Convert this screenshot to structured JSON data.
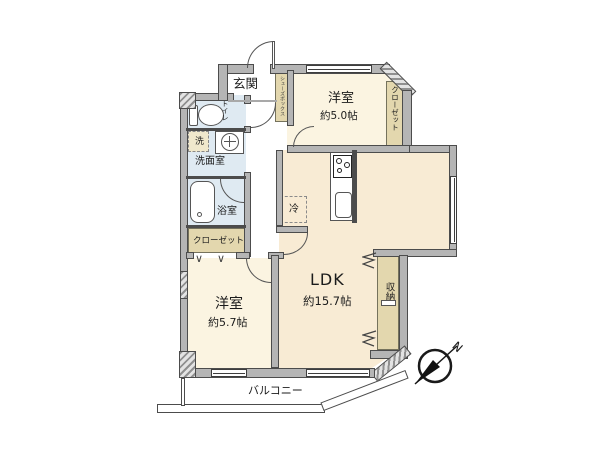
{
  "plan": {
    "rooms": {
      "entrance": {
        "label": "玄関"
      },
      "bedroom1": {
        "label": "洋室",
        "size": "約5.0帖"
      },
      "bedroom2": {
        "label": "洋室",
        "size": "約5.7帖"
      },
      "ldk": {
        "label": "LDK",
        "size": "約15.7帖"
      },
      "toilet": {
        "label": "トイレ"
      },
      "washroom": {
        "label": "洗面室"
      },
      "laundry": {
        "label": "洗"
      },
      "bathroom": {
        "label": "浴室"
      },
      "closet_left": {
        "label": "クローゼット"
      },
      "closet_right": {
        "label": "クローゼット"
      },
      "shoe_box": {
        "label": "シューズボックス"
      },
      "storage": {
        "label": "収納"
      },
      "refrigerator": {
        "label": "冷"
      },
      "balcony": {
        "label": "バルコニー"
      }
    },
    "compass": {
      "north_label": "N"
    },
    "colors": {
      "wall": "#b5b5b5",
      "bedroom_fill": "#fbf4e1",
      "ldk_fill": "#f8ebd4",
      "wet_area_fill": "#dfeaf2",
      "closet_fill": "#e3d7ae"
    }
  }
}
